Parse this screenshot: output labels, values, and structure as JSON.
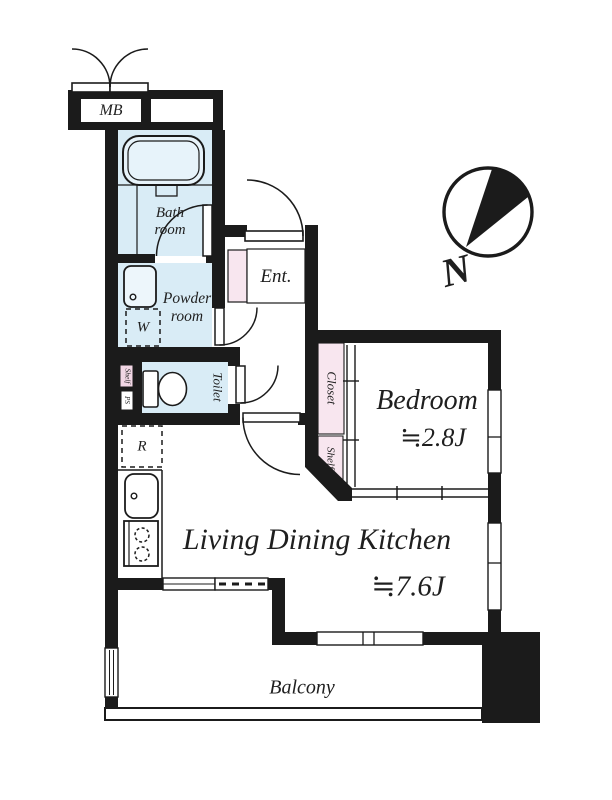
{
  "plan": {
    "compass": {
      "north_label": "N"
    },
    "rooms": {
      "bath": {
        "line1": "Bath",
        "line2": "room"
      },
      "powder": {
        "line1": "Powder",
        "line2": "room"
      },
      "toilet": {
        "name": "Toilet"
      },
      "entrance": {
        "name": "Ent."
      },
      "bedroom": {
        "name": "Bedroom",
        "area": "≒2.8J"
      },
      "ldk": {
        "name": "Living Dining Kitchen",
        "area": "≒7.6J"
      },
      "balcony": {
        "name": "Balcony"
      },
      "closet": {
        "name": "Closet"
      },
      "closet_shelf": {
        "name": "Shelf"
      }
    },
    "fixtures": {
      "meter_box": "MB",
      "washer": "W",
      "fridge": "R",
      "toilet_shelf": "Shelf",
      "pipe_space": "PS"
    },
    "colors": {
      "wall": "#1b1b1b",
      "wet_area": "#d9ecf6",
      "bathtub": "#e7f3fa",
      "sink": "#edf6fb",
      "storage": "#f8e6ef",
      "toilet_shelf_fill": "#f1d6e4",
      "white": "#ffffff"
    }
  }
}
